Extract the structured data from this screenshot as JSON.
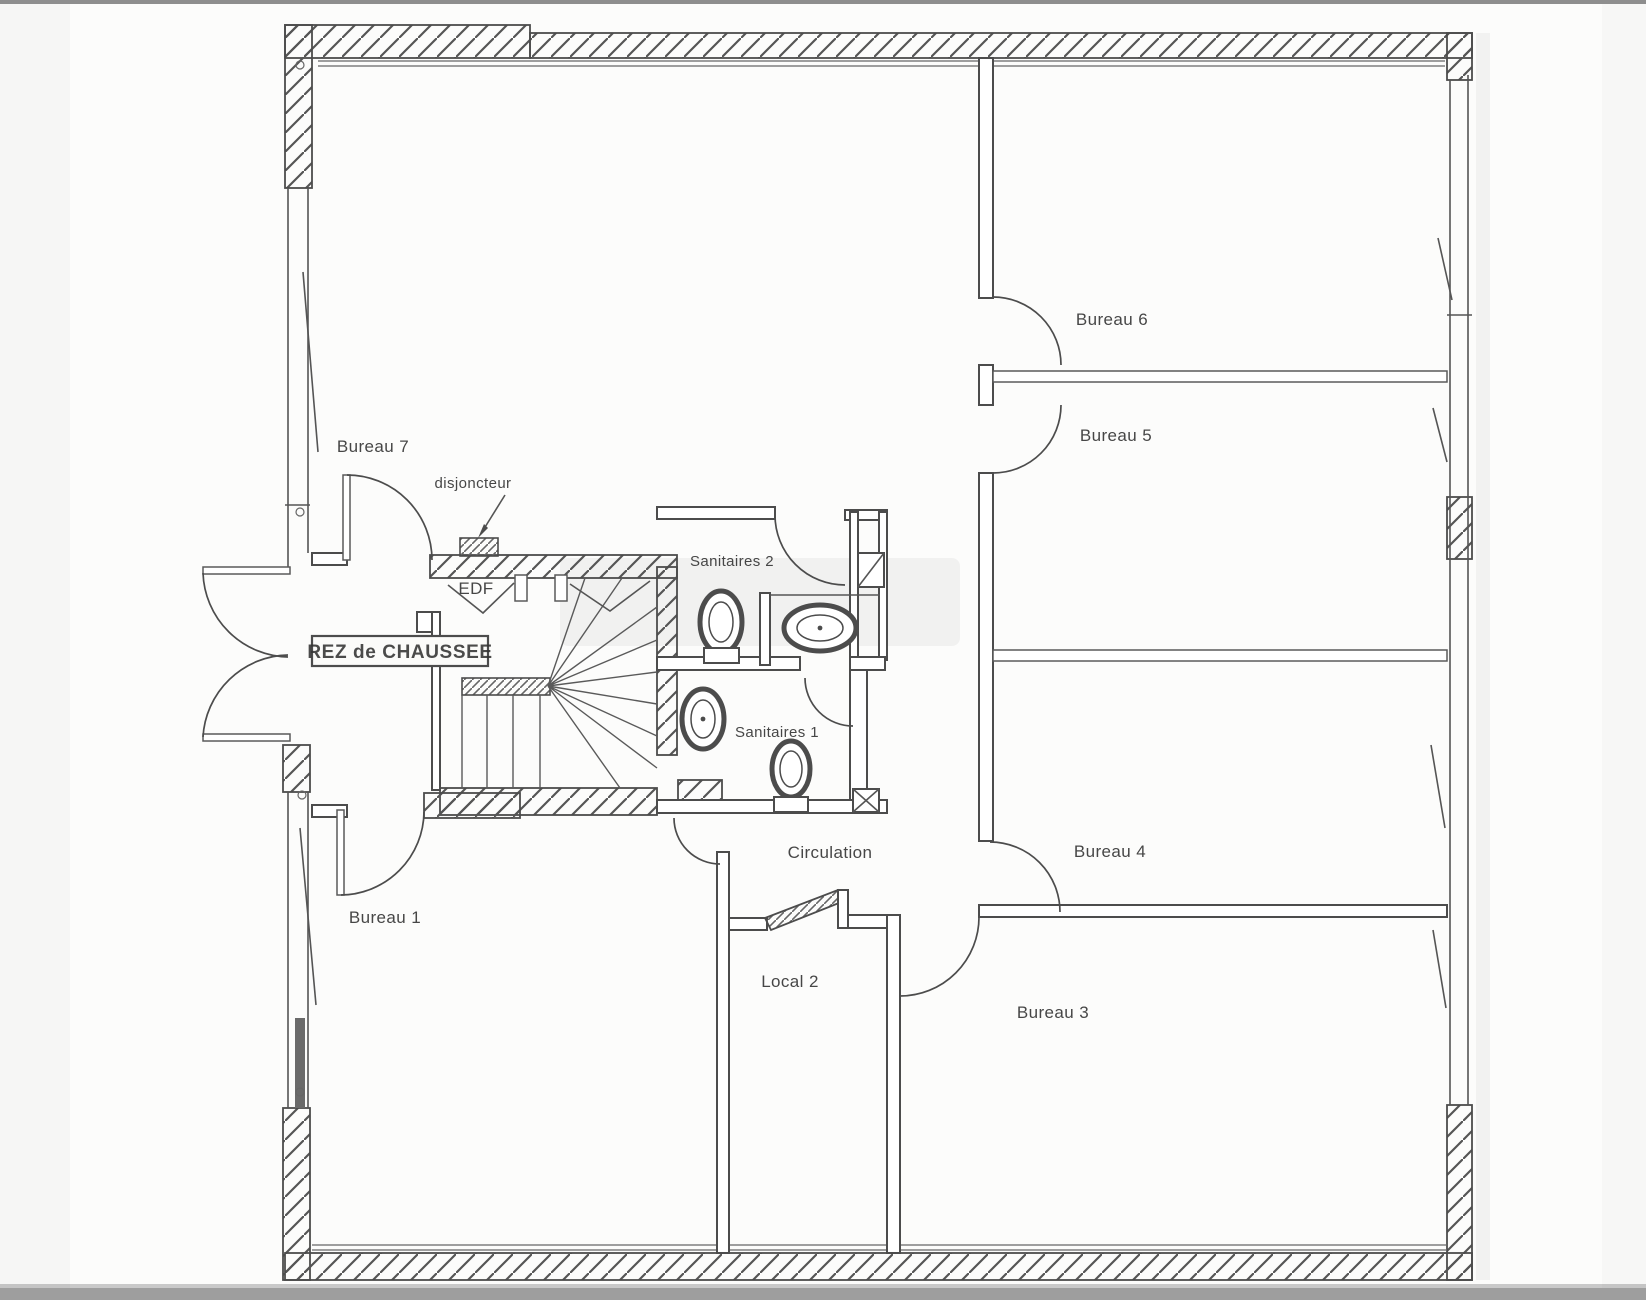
{
  "floor_plan": {
    "title_box": "REZ de CHAUSSEE",
    "rooms": {
      "bureau_1": "Bureau 1",
      "bureau_3": "Bureau 3",
      "bureau_4": "Bureau 4",
      "bureau_5": "Bureau 5",
      "bureau_6": "Bureau 6",
      "bureau_7": "Bureau 7",
      "local_2": "Local 2",
      "sanitaires_1": "Sanitaires 1",
      "sanitaires_2": "Sanitaires 2",
      "circulation": "Circulation",
      "edf": "EDF"
    },
    "annotations": {
      "disjoncteur": "disjoncteur"
    },
    "colors": {
      "ink": "#4c4c4c",
      "paper": "#fcfcfb",
      "scan_edge": "#9a9a9a"
    }
  }
}
